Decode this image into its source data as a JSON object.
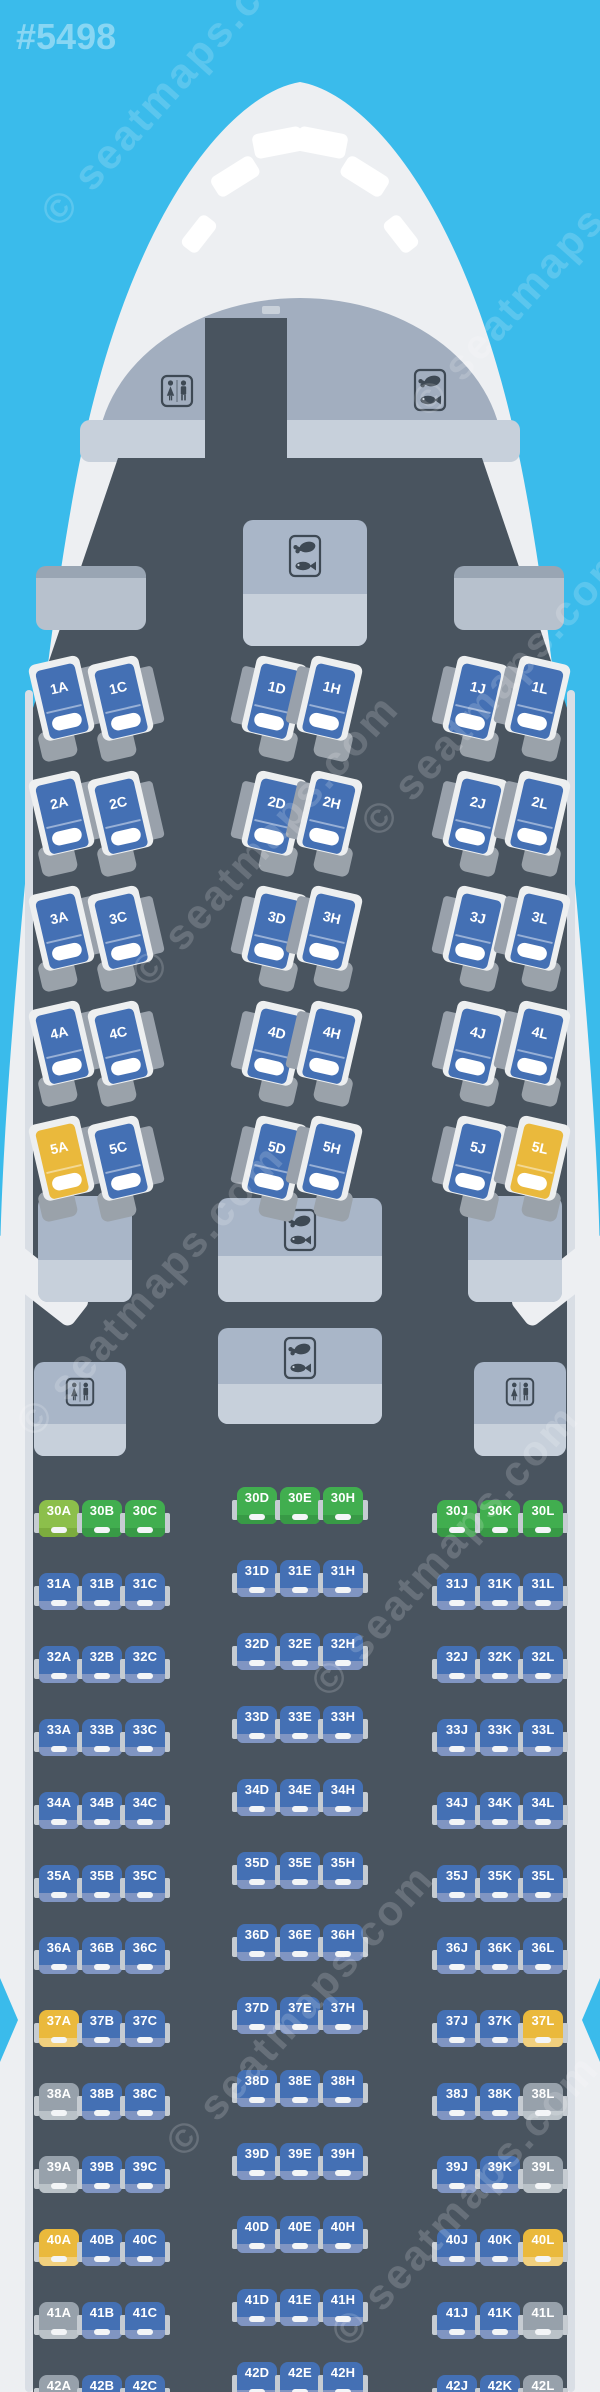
{
  "watermark": {
    "id": "#5498",
    "brand": "© seatmaps.com"
  },
  "colors": {
    "background": "#3ABBEB",
    "fuselage": "#EDEFF2",
    "cockpit_window": "#FFFFFF",
    "cabin": "#49545F",
    "cockpit_dome": "#A2AEBF",
    "bulkhead_band": "#C7D0DB",
    "cockpit_handle": "#C9D1DA",
    "box_top": "#A9B6C8",
    "box_bottom": "#C7D0DB",
    "bin_body": "#B7C1CD",
    "bin_edge": "#99A5B3",
    "icon_ink": "#3E4954",
    "shell": "#EDEFF0",
    "side_table": "#99A1AB",
    "foot": "#9AA2AA",
    "armrest": "#C6CCD2",
    "pillow": "#FFFFFF",
    "lining": "#D9DEE5",
    "watermark": "rgba(255,255,255,0.17)",
    "id_watermark": "rgba(255,255,255,0.40)",
    "seat_types": {
      "blue": {
        "body": "#4470B4",
        "lip": "#8095C2"
      },
      "green": {
        "body": "#41AE4F",
        "lip": "#389A46"
      },
      "lightgreen": {
        "body": "#8CBF4B",
        "lip": "#7CAC3E"
      },
      "yellow": {
        "body": "#EAB93C",
        "lip": "#F1D07E"
      },
      "gray": {
        "body": "#97A1AB",
        "lip": "#BAC2C8"
      }
    }
  },
  "aircraft": {
    "cockpit_windows": 6,
    "facility_icons": {
      "lavatory": "wc-icon",
      "galley": "meal-icon"
    }
  },
  "cabins": {
    "business": {
      "columns": [
        "A",
        "C",
        "D",
        "H",
        "J",
        "L"
      ],
      "rows": [
        {
          "row": "1",
          "colors": [
            "blue",
            "blue",
            "blue",
            "blue",
            "blue",
            "blue"
          ]
        },
        {
          "row": "2",
          "colors": [
            "blue",
            "blue",
            "blue",
            "blue",
            "blue",
            "blue"
          ]
        },
        {
          "row": "3",
          "colors": [
            "blue",
            "blue",
            "blue",
            "blue",
            "blue",
            "blue"
          ]
        },
        {
          "row": "4",
          "colors": [
            "blue",
            "blue",
            "blue",
            "blue",
            "blue",
            "blue"
          ]
        },
        {
          "row": "5",
          "colors": [
            "yellow",
            "blue",
            "blue",
            "blue",
            "blue",
            "yellow"
          ]
        }
      ]
    },
    "economy": {
      "columns": [
        "A",
        "B",
        "C",
        "D",
        "E",
        "H",
        "J",
        "K",
        "L"
      ],
      "rows": [
        {
          "row": "30",
          "colors": [
            "lightgreen",
            "green",
            "green",
            "green",
            "green",
            "green",
            "green",
            "green",
            "green"
          ]
        },
        {
          "row": "31",
          "colors": [
            "blue",
            "blue",
            "blue",
            "blue",
            "blue",
            "blue",
            "blue",
            "blue",
            "blue"
          ]
        },
        {
          "row": "32",
          "colors": [
            "blue",
            "blue",
            "blue",
            "blue",
            "blue",
            "blue",
            "blue",
            "blue",
            "blue"
          ]
        },
        {
          "row": "33",
          "colors": [
            "blue",
            "blue",
            "blue",
            "blue",
            "blue",
            "blue",
            "blue",
            "blue",
            "blue"
          ]
        },
        {
          "row": "34",
          "colors": [
            "blue",
            "blue",
            "blue",
            "blue",
            "blue",
            "blue",
            "blue",
            "blue",
            "blue"
          ]
        },
        {
          "row": "35",
          "colors": [
            "blue",
            "blue",
            "blue",
            "blue",
            "blue",
            "blue",
            "blue",
            "blue",
            "blue"
          ]
        },
        {
          "row": "36",
          "colors": [
            "blue",
            "blue",
            "blue",
            "blue",
            "blue",
            "blue",
            "blue",
            "blue",
            "blue"
          ]
        },
        {
          "row": "37",
          "colors": [
            "yellow",
            "blue",
            "blue",
            "blue",
            "blue",
            "blue",
            "blue",
            "blue",
            "yellow"
          ]
        },
        {
          "row": "38",
          "colors": [
            "gray",
            "blue",
            "blue",
            "blue",
            "blue",
            "blue",
            "blue",
            "blue",
            "gray"
          ]
        },
        {
          "row": "39",
          "colors": [
            "gray",
            "blue",
            "blue",
            "blue",
            "blue",
            "blue",
            "blue",
            "blue",
            "gray"
          ]
        },
        {
          "row": "40",
          "colors": [
            "yellow",
            "blue",
            "blue",
            "blue",
            "blue",
            "blue",
            "blue",
            "blue",
            "yellow"
          ]
        },
        {
          "row": "41",
          "colors": [
            "gray",
            "blue",
            "blue",
            "blue",
            "blue",
            "blue",
            "blue",
            "blue",
            "gray"
          ]
        },
        {
          "row": "42",
          "colors": [
            "gray",
            "blue",
            "blue",
            "blue",
            "blue",
            "blue",
            "blue",
            "blue",
            "gray"
          ]
        }
      ]
    }
  }
}
